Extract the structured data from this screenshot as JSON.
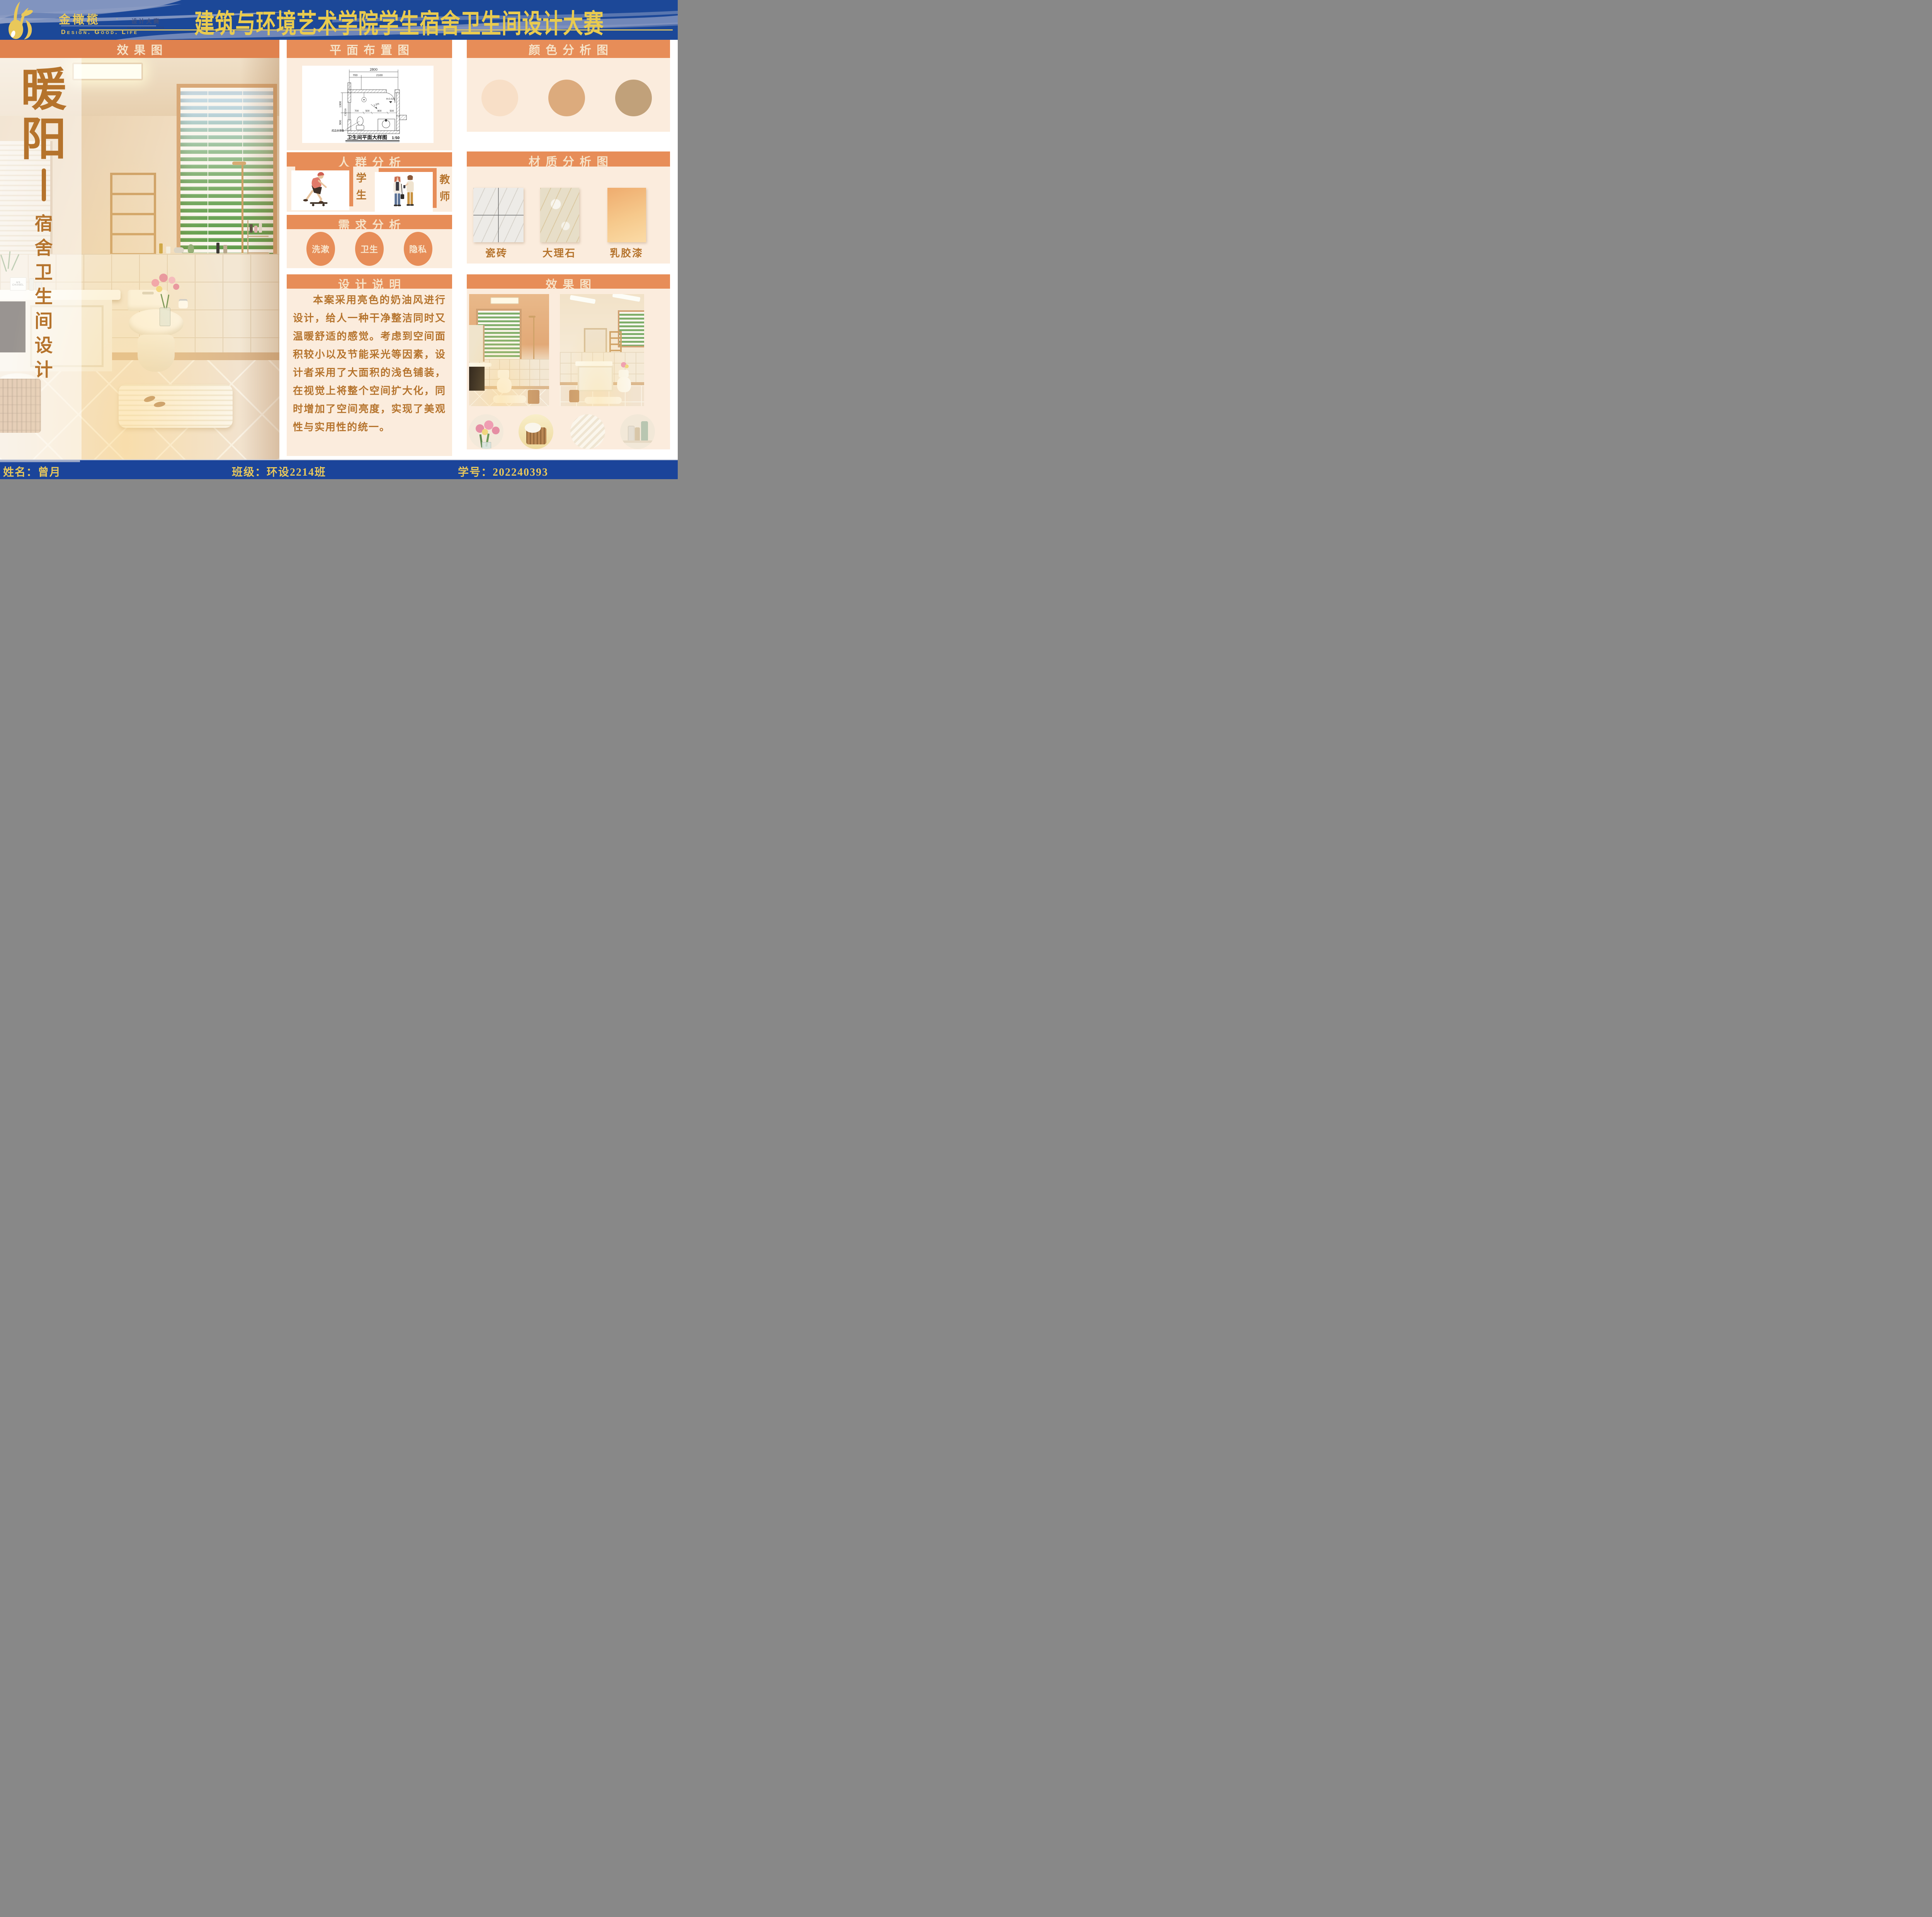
{
  "banner": {
    "brand": "金橄榄",
    "brand_dot": "·",
    "brand_sub": "设计大赛",
    "brand_sub_en": "DESIGN COMPETITION",
    "tagline": "Design. Good. Life",
    "title": "建筑与环境艺术学院学生宿舍卫生间设计大赛",
    "colors": {
      "bg": "#1c4898",
      "gold": "#e9c85a",
      "wave": "#8d9cc3"
    }
  },
  "left_panel": {
    "header": "效果图",
    "title_char_1": "暖",
    "title_char_2": "阳",
    "subtitle_chars": [
      "宿",
      "舍",
      "卫",
      "生",
      "间",
      "设",
      "计"
    ],
    "perfume": {
      "line1": "N°5",
      "line2": "CHANEL"
    }
  },
  "middle_column": {
    "floor_plan": {
      "header": "平面布置图",
      "dim_total": "2800",
      "dim_a": "700",
      "dim_b": "2100",
      "dim_left_a": "1300",
      "dim_left_b": "900",
      "dim_inner": [
        "700",
        "500",
        "900",
        "500"
      ],
      "slope": "1.5%",
      "door_level": "H-0.020",
      "window_code": "C1216",
      "toilet_note": "成品坐便器",
      "caption": "卫生间平面大样图",
      "scale": "1:50"
    },
    "crowd": {
      "header": "人群分析",
      "left_label": "学生",
      "right_label": "教师"
    },
    "needs": {
      "header": "需求分析",
      "items": [
        "洗漱",
        "卫生",
        "隐私"
      ]
    },
    "description": {
      "header": "设计说明",
      "body": "本案采用亮色的奶油风进行设计，给人一种干净整洁同时又温暖舒适的感觉。考虑到空间面积较小以及节能采光等因素，设计者采用了大面积的浅色铺装，在视觉上将整个空间扩大化，同时增加了空间亮度，实现了美观性与实用性的统一。"
    }
  },
  "right_column": {
    "colors_section": {
      "header": "颜色分析图",
      "swatches": [
        "#f8dfc7",
        "#dcab7d",
        "#c1a17a"
      ]
    },
    "materials_section": {
      "header": "材质分析图",
      "labels": [
        "瓷砖",
        "大理石",
        "乳胶漆"
      ]
    },
    "renders_section": {
      "header": "效果图"
    }
  },
  "footer": {
    "name_label": "姓名：",
    "name_value": "曾月",
    "class_label": "班级：",
    "class_value": "环设2214班",
    "id_label": "学号：",
    "id_value": "202240393"
  }
}
